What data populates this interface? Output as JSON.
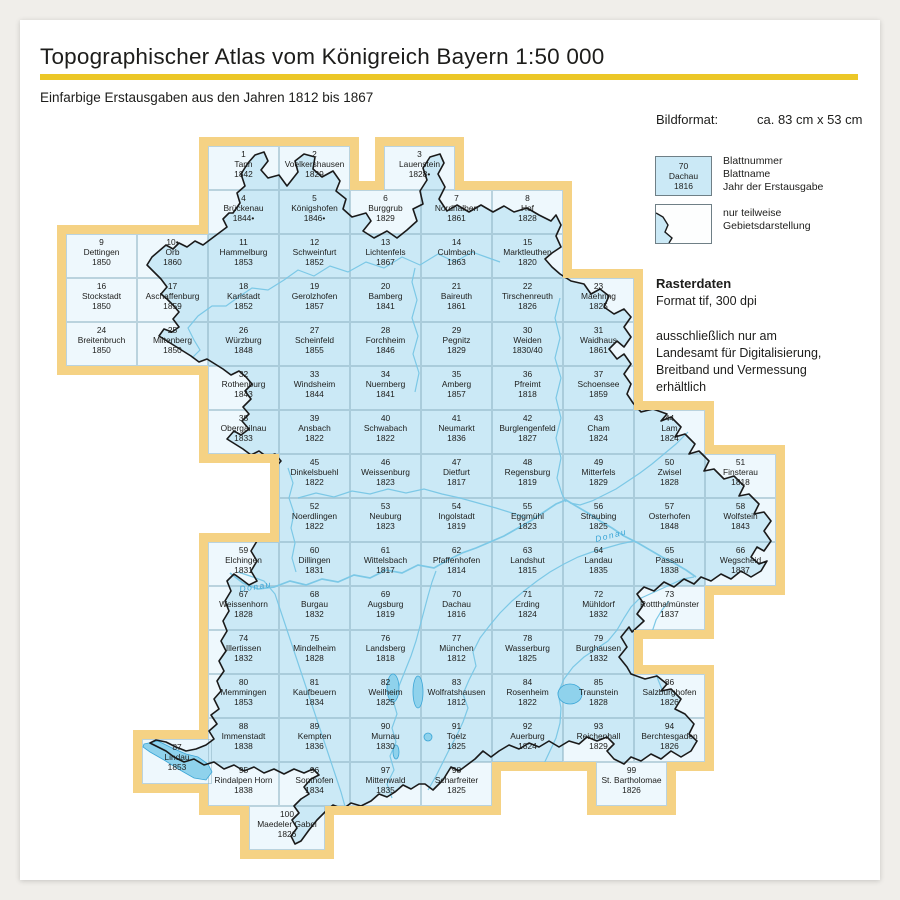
{
  "page": {
    "title": "Topographischer Atlas vom Königreich Bayern 1:50 000",
    "subtitle": "Einfarbige Erstausgaben aus den Jahren 1812 bis 1867"
  },
  "info": {
    "bildformat_label": "Bildformat:",
    "bildformat_value": "ca. 83 cm x 53 cm"
  },
  "legend": {
    "sample": {
      "number": "70",
      "name": "Dachau",
      "year": "1816"
    },
    "sample_labels": [
      "Blattnummer",
      "Blattname",
      "Jahr der Erstausgabe"
    ],
    "partial_labels": [
      "nur teilweise",
      "Gebietsdarstellung"
    ]
  },
  "raster": {
    "heading": "Rasterdaten",
    "format": "Format tif, 300 dpi",
    "note_lines": [
      "ausschließlich nur am",
      "Landesamt für Digitalisierung,",
      "Breitband und Vermessung",
      "erhältlich"
    ]
  },
  "colors": {
    "accent_yellow": "#ecc727",
    "map_border_yellow": "#f5d284",
    "sheet_blue": "#cbe9f6",
    "sheet_white": "#eef8fd",
    "boundary_black": "#1a1a1a",
    "river_blue": "#7cc8e6",
    "lake_blue": "#8fd2ec",
    "grid_line": "#8fb4c4",
    "text": "#1d1d1b"
  },
  "map": {
    "river_labels": [
      {
        "text": "Donau",
        "x": 240,
        "y": 592,
        "rot": -9
      },
      {
        "text": "Donau",
        "x": 596,
        "y": 542,
        "rot": -14
      }
    ],
    "sheets": [
      {
        "num": "1",
        "name": "Tann",
        "year": "1842",
        "col": 2,
        "row": 0,
        "partial": true
      },
      {
        "num": "2",
        "name": "Voelkershausen",
        "year": "1829",
        "col": 3,
        "row": 0,
        "partial": true
      },
      {
        "num": "3",
        "name": "Lauenstein",
        "year": "1828•",
        "col": 4,
        "row": 0,
        "x": 384,
        "partial": true
      },
      {
        "num": "4",
        "name": "Brückenau",
        "year": "1844•",
        "col": 2,
        "row": 1,
        "partial": true
      },
      {
        "num": "5",
        "name": "Königshofen",
        "year": "1846•",
        "col": 3,
        "row": 1,
        "partial": false
      },
      {
        "num": "6",
        "name": "Burggrub",
        "year": "1829",
        "col": 4,
        "row": 1,
        "partial": true
      },
      {
        "num": "7",
        "name": "Nordhalben",
        "year": "1861",
        "col": 5,
        "row": 1,
        "partial": true
      },
      {
        "num": "8",
        "name": "Hof",
        "year": "1828",
        "col": 6,
        "row": 1,
        "partial": true
      },
      {
        "num": "9",
        "name": "Dettingen",
        "year": "1850",
        "col": 0,
        "row": 2,
        "partial": true
      },
      {
        "num": "10•",
        "name": "Orb",
        "year": "1860",
        "col": 1,
        "row": 2,
        "partial": true
      },
      {
        "num": "11",
        "name": "Hammelburg",
        "year": "1853",
        "col": 2,
        "row": 2,
        "partial": false
      },
      {
        "num": "12",
        "name": "Schweinfurt",
        "year": "1852",
        "col": 3,
        "row": 2,
        "partial": false
      },
      {
        "num": "13",
        "name": "Lichtenfels",
        "year": "1867",
        "col": 4,
        "row": 2,
        "partial": false
      },
      {
        "num": "14",
        "name": "Culmbach",
        "year": "1863",
        "col": 5,
        "row": 2,
        "partial": false
      },
      {
        "num": "15",
        "name": "Marktleuthen",
        "year": "1820",
        "col": 6,
        "row": 2,
        "partial": true
      },
      {
        "num": "16",
        "name": "Stockstadt",
        "year": "1850",
        "col": 0,
        "row": 3,
        "partial": true
      },
      {
        "num": "17",
        "name": "Aschaffenburg",
        "year": "1859",
        "col": 1,
        "row": 3,
        "partial": true
      },
      {
        "num": "18",
        "name": "Karlstadt",
        "year": "1852",
        "col": 2,
        "row": 3,
        "partial": false
      },
      {
        "num": "19",
        "name": "Gerolzhofen",
        "year": "1857",
        "col": 3,
        "row": 3,
        "partial": false
      },
      {
        "num": "20",
        "name": "Bamberg",
        "year": "1841",
        "col": 4,
        "row": 3,
        "partial": false
      },
      {
        "num": "21",
        "name": "Baireuth",
        "year": "1861",
        "col": 5,
        "row": 3,
        "partial": false
      },
      {
        "num": "22",
        "name": "Tirschenreuth",
        "year": "1826",
        "col": 6,
        "row": 3,
        "partial": false
      },
      {
        "num": "23",
        "name": "Maehring",
        "year": "1825",
        "col": 7,
        "row": 3,
        "partial": true
      },
      {
        "num": "24",
        "name": "Breitenbruch",
        "year": "1850",
        "col": 0,
        "row": 4,
        "partial": true
      },
      {
        "num": "25",
        "name": "Miltenberg",
        "year": "1850",
        "col": 1,
        "row": 4,
        "partial": true
      },
      {
        "num": "26",
        "name": "Würzburg",
        "year": "1848",
        "col": 2,
        "row": 4,
        "partial": false
      },
      {
        "num": "27",
        "name": "Scheinfeld",
        "year": "1855",
        "col": 3,
        "row": 4,
        "partial": false
      },
      {
        "num": "28",
        "name": "Forchheim",
        "year": "1846",
        "col": 4,
        "row": 4,
        "partial": false
      },
      {
        "num": "29",
        "name": "Pegnitz",
        "year": "1829",
        "col": 5,
        "row": 4,
        "partial": false
      },
      {
        "num": "30",
        "name": "Weiden",
        "year": "1830/40",
        "col": 6,
        "row": 4,
        "partial": false
      },
      {
        "num": "31",
        "name": "Waidhaus",
        "year": "1861",
        "col": 7,
        "row": 4,
        "partial": true
      },
      {
        "num": "32",
        "name": "Rothenburg",
        "year": "1843",
        "col": 2,
        "row": 5,
        "partial": true
      },
      {
        "num": "33",
        "name": "Windsheim",
        "year": "1844",
        "col": 3,
        "row": 5,
        "partial": false
      },
      {
        "num": "34",
        "name": "Nuernberg",
        "year": "1841",
        "col": 4,
        "row": 5,
        "partial": false
      },
      {
        "num": "35",
        "name": "Amberg",
        "year": "1857",
        "col": 5,
        "row": 5,
        "partial": false
      },
      {
        "num": "36",
        "name": "Pfreimt",
        "year": "1818",
        "col": 6,
        "row": 5,
        "partial": false
      },
      {
        "num": "37",
        "name": "Schoensee",
        "year": "1859",
        "col": 7,
        "row": 5,
        "partial": true
      },
      {
        "num": "38",
        "name": "Obergailnau",
        "year": "1833",
        "col": 2,
        "row": 6,
        "partial": true
      },
      {
        "num": "39",
        "name": "Ansbach",
        "year": "1822",
        "col": 3,
        "row": 6,
        "partial": false
      },
      {
        "num": "40",
        "name": "Schwabach",
        "year": "1822",
        "col": 4,
        "row": 6,
        "partial": false
      },
      {
        "num": "41",
        "name": "Neumarkt",
        "year": "1836",
        "col": 5,
        "row": 6,
        "partial": false
      },
      {
        "num": "42",
        "name": "Burglengenfeld",
        "year": "1827",
        "col": 6,
        "row": 6,
        "partial": false
      },
      {
        "num": "43",
        "name": "Cham",
        "year": "1824",
        "col": 7,
        "row": 6,
        "partial": false
      },
      {
        "num": "44",
        "name": "Lam",
        "year": "1824",
        "col": 8,
        "row": 6,
        "partial": true
      },
      {
        "num": "45",
        "name": "Dinkelsbuehl",
        "year": "1822",
        "col": 3,
        "row": 7,
        "partial": true
      },
      {
        "num": "46",
        "name": "Weissenburg",
        "year": "1823",
        "col": 4,
        "row": 7,
        "partial": false
      },
      {
        "num": "47",
        "name": "Dietfurt",
        "year": "1817",
        "col": 5,
        "row": 7,
        "partial": false
      },
      {
        "num": "48",
        "name": "Regensburg",
        "year": "1819",
        "col": 6,
        "row": 7,
        "partial": false
      },
      {
        "num": "49",
        "name": "Mitterfels",
        "year": "1829",
        "col": 7,
        "row": 7,
        "partial": false
      },
      {
        "num": "50",
        "name": "Zwisel",
        "year": "1828",
        "col": 8,
        "row": 7,
        "partial": false
      },
      {
        "num": "51",
        "name": "Finsterau",
        "year": "1818",
        "col": 9,
        "row": 7,
        "partial": true
      },
      {
        "num": "52",
        "name": "Noerdlingen",
        "year": "1822",
        "col": 3,
        "row": 8,
        "partial": true
      },
      {
        "num": "53",
        "name": "Neuburg",
        "year": "1823",
        "col": 4,
        "row": 8,
        "partial": false
      },
      {
        "num": "54",
        "name": "Ingolstadt",
        "year": "1819",
        "col": 5,
        "row": 8,
        "partial": false
      },
      {
        "num": "55",
        "name": "Eggmühl",
        "year": "1823",
        "col": 6,
        "row": 8,
        "partial": false
      },
      {
        "num": "56",
        "name": "Straubing",
        "year": "1825",
        "col": 7,
        "row": 8,
        "partial": false
      },
      {
        "num": "57",
        "name": "Osterhofen",
        "year": "1848",
        "col": 8,
        "row": 8,
        "partial": false
      },
      {
        "num": "58",
        "name": "Wolfstein",
        "year": "1843",
        "col": 9,
        "row": 8,
        "partial": true
      },
      {
        "num": "59",
        "name": "Elchingen",
        "year": "1831",
        "col": 2,
        "row": 9,
        "partial": true
      },
      {
        "num": "60",
        "name": "Dillingen",
        "year": "1831",
        "col": 3,
        "row": 9,
        "partial": false
      },
      {
        "num": "61",
        "name": "Wittelsbach",
        "year": "1817",
        "col": 4,
        "row": 9,
        "partial": false
      },
      {
        "num": "62",
        "name": "Pfaffenhofen",
        "year": "1814",
        "col": 5,
        "row": 9,
        "partial": false
      },
      {
        "num": "63",
        "name": "Landshut",
        "year": "1815",
        "col": 6,
        "row": 9,
        "partial": false
      },
      {
        "num": "64",
        "name": "Landau",
        "year": "1835",
        "col": 7,
        "row": 9,
        "partial": false
      },
      {
        "num": "65",
        "name": "Passau",
        "year": "1838",
        "col": 8,
        "row": 9,
        "partial": false
      },
      {
        "num": "66",
        "name": "Wegscheid",
        "year": "1837",
        "col": 9,
        "row": 9,
        "partial": true
      },
      {
        "num": "67",
        "name": "Weissenhorn",
        "year": "1828",
        "col": 2,
        "row": 10,
        "partial": true
      },
      {
        "num": "68",
        "name": "Burgau",
        "year": "1832",
        "col": 3,
        "row": 10,
        "partial": false
      },
      {
        "num": "69",
        "name": "Augsburg",
        "year": "1819",
        "col": 4,
        "row": 10,
        "partial": false
      },
      {
        "num": "70",
        "name": "Dachau",
        "year": "1816",
        "col": 5,
        "row": 10,
        "partial": false
      },
      {
        "num": "71",
        "name": "Erding",
        "year": "1824",
        "col": 6,
        "row": 10,
        "partial": false
      },
      {
        "num": "72",
        "name": "Mühldorf",
        "year": "1832",
        "col": 7,
        "row": 10,
        "partial": false
      },
      {
        "num": "73",
        "name": "Rottthalmünster",
        "year": "1837",
        "col": 8,
        "row": 10,
        "partial": true
      },
      {
        "num": "74",
        "name": "Illertissen",
        "year": "1832",
        "col": 2,
        "row": 11,
        "partial": true
      },
      {
        "num": "75",
        "name": "Mindelheim",
        "year": "1828",
        "col": 3,
        "row": 11,
        "partial": false
      },
      {
        "num": "76",
        "name": "Landsberg",
        "year": "1818",
        "col": 4,
        "row": 11,
        "partial": false
      },
      {
        "num": "77",
        "name": "München",
        "year": "1812",
        "col": 5,
        "row": 11,
        "partial": false
      },
      {
        "num": "78",
        "name": "Wasserburg",
        "year": "1825",
        "col": 6,
        "row": 11,
        "partial": false
      },
      {
        "num": "79",
        "name": "Burghausen",
        "year": "1832",
        "col": 7,
        "row": 11,
        "partial": false
      },
      {
        "num": "80",
        "name": "Memmingen",
        "year": "1853",
        "col": 2,
        "row": 12,
        "partial": true
      },
      {
        "num": "81",
        "name": "Kaufbeuern",
        "year": "1834",
        "col": 3,
        "row": 12,
        "partial": false
      },
      {
        "num": "82",
        "name": "Weilheim",
        "year": "1825",
        "col": 4,
        "row": 12,
        "partial": false
      },
      {
        "num": "83",
        "name": "Wolfratshausen",
        "year": "1812",
        "col": 5,
        "row": 12,
        "partial": false
      },
      {
        "num": "84",
        "name": "Rosenheim",
        "year": "1822",
        "col": 6,
        "row": 12,
        "partial": false
      },
      {
        "num": "85",
        "name": "Traunstein",
        "year": "1828",
        "col": 7,
        "row": 12,
        "partial": false
      },
      {
        "num": "86",
        "name": "Salzburghofen",
        "year": "1826",
        "col": 8,
        "row": 12,
        "partial": true
      },
      {
        "num": "87",
        "name": "Lindau",
        "year": "1853",
        "col": 1,
        "row": 13,
        "x": 142,
        "y": 739,
        "w": 70,
        "h": 45,
        "partial": true
      },
      {
        "num": "88",
        "name": "Immenstadt",
        "year": "1838",
        "col": 2,
        "row": 13,
        "partial": true
      },
      {
        "num": "89",
        "name": "Kempten",
        "year": "1836",
        "col": 3,
        "row": 13,
        "partial": false
      },
      {
        "num": "90",
        "name": "Murnau",
        "year": "1830",
        "col": 4,
        "row": 13,
        "partial": false
      },
      {
        "num": "91",
        "name": "Toelz",
        "year": "1825",
        "col": 5,
        "row": 13,
        "partial": false
      },
      {
        "num": "92",
        "name": "Auerburg",
        "year": "1824",
        "col": 6,
        "row": 13,
        "partial": false
      },
      {
        "num": "93",
        "name": "Reichenhall",
        "year": "1829",
        "col": 7,
        "row": 13,
        "partial": true
      },
      {
        "num": "94",
        "name": "Berchtesgaden",
        "year": "1826",
        "col": 8,
        "row": 13,
        "partial": true
      },
      {
        "num": "95",
        "name": "Rindalpen Horn",
        "year": "1838",
        "col": 2,
        "row": 14,
        "partial": true
      },
      {
        "num": "96",
        "name": "Sonthofen",
        "year": "1834",
        "col": 3,
        "row": 14,
        "partial": true
      },
      {
        "num": "97",
        "name": "Mittenwald",
        "year": "1835",
        "col": 4,
        "row": 14,
        "partial": true
      },
      {
        "num": "98",
        "name": "Scharfreiter",
        "year": "1825",
        "col": 5,
        "row": 14,
        "partial": true
      },
      {
        "num": "99",
        "name": "St. Bartholomae",
        "year": "1826",
        "col": 7,
        "row": 14,
        "x": 596,
        "partial": true
      },
      {
        "num": "100",
        "name": "Maedeler Gabel",
        "year": "1826",
        "col": 2,
        "row": 15,
        "x": 249,
        "w": 76,
        "partial": true
      }
    ]
  }
}
